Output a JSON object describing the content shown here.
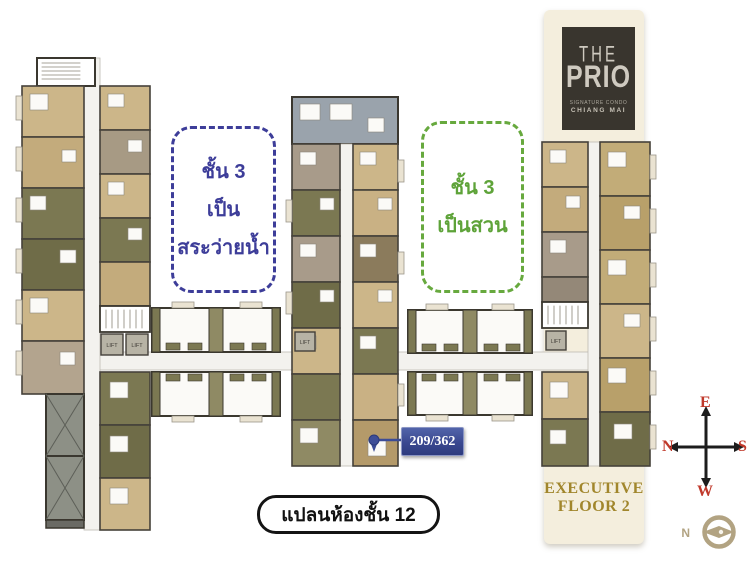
{
  "logo": {
    "the": "THE",
    "prio": "PRIO",
    "sub1": "SIGNATURE CONDO",
    "sub2": "CHIANG MAI"
  },
  "notes": {
    "pool": {
      "l1": "ชั้น 3",
      "l2": "เป็น",
      "l3": "สระว่ายน้ำ"
    },
    "garden": {
      "l1": "ชั้น 3",
      "l2": "เป็นสวน"
    }
  },
  "unit_marker": {
    "label": "209/362"
  },
  "caption": {
    "text": "แปลนห้องชั้น 12"
  },
  "executive": {
    "l1": "EXECUTIVE",
    "l2": "FLOOR 2"
  },
  "compass": {
    "top": "E",
    "right": "S",
    "bottom": "W",
    "left": "N"
  },
  "north_icon": {
    "label": "N"
  },
  "plan": {
    "lift": "LIFT"
  },
  "colors": {
    "note_blue": "#3d3d99",
    "note_green": "#5ea339",
    "marker_navy": "#3c4c96",
    "executive_gold": "#a1862c",
    "compass_red": "#c0392b",
    "north_icon_tan": "#b2a382",
    "cream_band": "#f4eedd",
    "logo_bg": "#39352e",
    "room_tan": "#ccb689",
    "room_olive": "#7b7852",
    "room_taupe": "#a89b8a",
    "room_khaki": "#c2ac78",
    "room_grayblue": "#9aa3ac",
    "void_gray": "#8d9086"
  }
}
